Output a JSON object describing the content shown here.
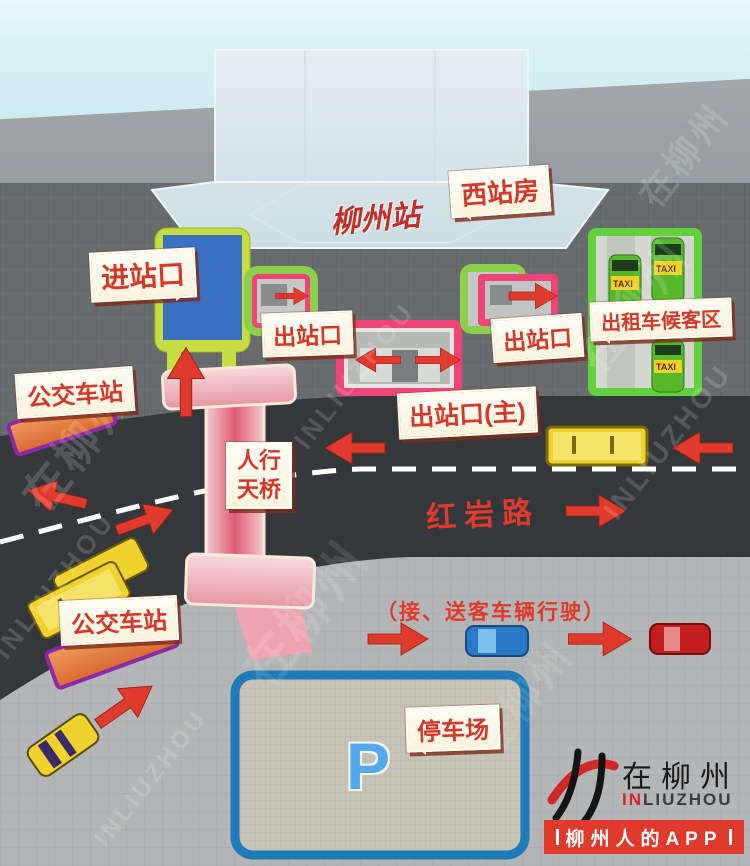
{
  "theme": {
    "accent_red": "#e03a2c",
    "label_bg": "#fdf4de",
    "label_text": "#d4382a",
    "road": "#35383b",
    "entrance_blue": "#3a70c0",
    "exit_pink": "#ee4478",
    "area_green": "#62d23c",
    "parking_blue": "#1e7ab8",
    "bridge_pink": "#eeb4be",
    "vehicle_yellow": "#f0d22e",
    "sky": "#cdeaf0"
  },
  "station": {
    "name": "柳州站",
    "west_building": "西站房"
  },
  "labels": {
    "entrance": "进站口",
    "exit": "出站口",
    "exit_main": "出站口(主)",
    "taxi_area": "出租车候客区",
    "bus_station": "公交车站",
    "footbridge": [
      "人行",
      "天桥"
    ],
    "parking": "停车场",
    "parking_symbol": "P",
    "taxi_roof": "TAXI"
  },
  "road": {
    "name": "红岩路",
    "pickup_note": "（接、送客车辆行驶）"
  },
  "watermark": {
    "cn": "在柳州",
    "en": "INLIUZHOU"
  },
  "logo": {
    "brand_cn": "在柳州",
    "en_prefix": "IN",
    "en_suffix": "LIUZHOU",
    "banner": "柳州人的APP"
  }
}
